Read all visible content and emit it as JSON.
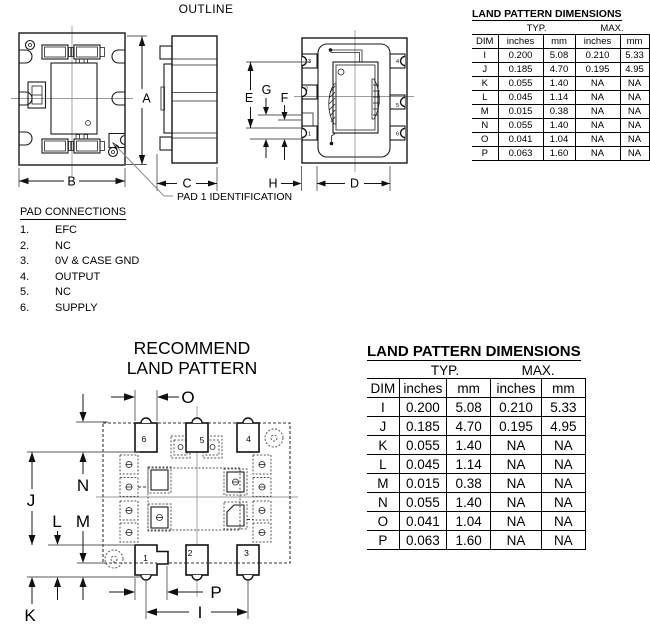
{
  "outline": {
    "title": "OUTLINE",
    "pad1_callout": "PAD 1 IDENTIFICATION",
    "dim_labels": {
      "A": "A",
      "B": "B",
      "C": "C",
      "D": "D",
      "E": "E",
      "F": "F",
      "G": "G",
      "H": "H"
    },
    "pad_numbers": [
      "1",
      "2",
      "3",
      "4",
      "5",
      "6"
    ]
  },
  "pad_connections": {
    "title": "PAD CONNECTIONS",
    "items": [
      {
        "num": "1.",
        "label": "EFC"
      },
      {
        "num": "2.",
        "label": "NC"
      },
      {
        "num": "3.",
        "label": "0V & CASE GND"
      },
      {
        "num": "4.",
        "label": "OUTPUT"
      },
      {
        "num": "5.",
        "label": "NC"
      },
      {
        "num": "6.",
        "label": "SUPPLY"
      }
    ]
  },
  "dimensions_table": {
    "title": "LAND PATTERN DIMENSIONS",
    "group_typ": "TYP.",
    "group_max": "MAX.",
    "headers": [
      "DIM",
      "inches",
      "mm",
      "inches",
      "mm"
    ],
    "rows": [
      {
        "dim": "I",
        "typ_in": "0.200",
        "typ_mm": "5.08",
        "max_in": "0.210",
        "max_mm": "5.33"
      },
      {
        "dim": "J",
        "typ_in": "0.185",
        "typ_mm": "4.70",
        "max_in": "0.195",
        "max_mm": "4.95"
      },
      {
        "dim": "K",
        "typ_in": "0.055",
        "typ_mm": "1.40",
        "max_in": "NA",
        "max_mm": "NA"
      },
      {
        "dim": "L",
        "typ_in": "0.045",
        "typ_mm": "1.14",
        "max_in": "NA",
        "max_mm": "NA"
      },
      {
        "dim": "M",
        "typ_in": "0.015",
        "typ_mm": "0.38",
        "max_in": "NA",
        "max_mm": "NA"
      },
      {
        "dim": "N",
        "typ_in": "0.055",
        "typ_mm": "1.40",
        "max_in": "NA",
        "max_mm": "NA"
      },
      {
        "dim": "O",
        "typ_in": "0.041",
        "typ_mm": "1.04",
        "max_in": "NA",
        "max_mm": "NA"
      },
      {
        "dim": "P",
        "typ_in": "0.063",
        "typ_mm": "1.60",
        "max_in": "NA",
        "max_mm": "NA"
      }
    ]
  },
  "land_pattern": {
    "title_line1": "RECOMMEND",
    "title_line2": "LAND PATTERN",
    "dim_labels": {
      "I": "I",
      "J": "J",
      "K": "K",
      "L": "L",
      "M": "M",
      "N": "N",
      "O": "O",
      "P": "P"
    },
    "pad_numbers": [
      "1",
      "2",
      "3",
      "4",
      "5",
      "6"
    ]
  }
}
